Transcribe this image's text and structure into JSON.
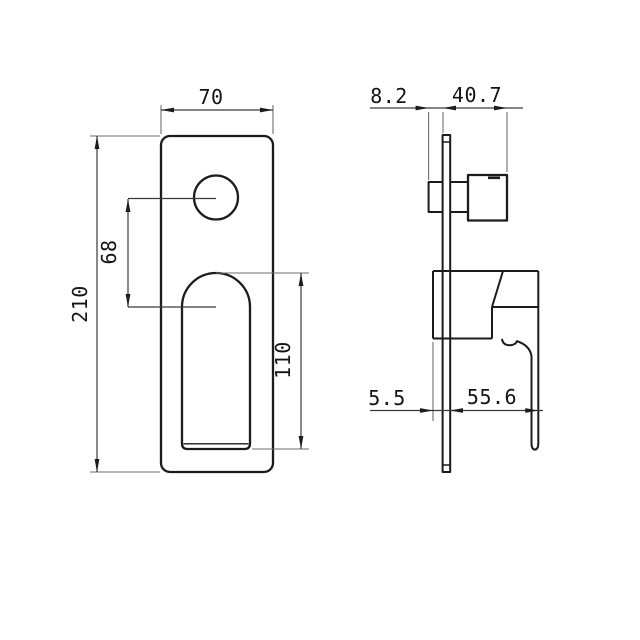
{
  "colors": {
    "background": "#ffffff",
    "line": "#1c1c1c",
    "dim_line": "#6e6e6e",
    "text": "#141414"
  },
  "front_view": {
    "dim_width_mm": "70",
    "dim_height_mm": "210",
    "dim_handle_center_offset_mm": "68",
    "dim_cutout_height_mm": "110"
  },
  "side_view": {
    "dim_body_depth_mm": "8.2",
    "dim_knob_projection_mm": "40.7",
    "dim_plate_thickness_mm": "5.5",
    "dim_lever_projection_mm": "55.6"
  }
}
